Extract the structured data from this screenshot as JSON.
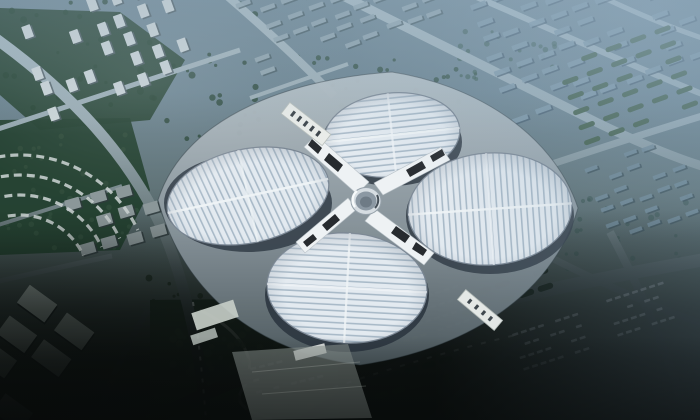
{
  "image": {
    "kind": "architectural-aerial-rendering",
    "subject": "Aerial rendering of a four-petal clover-shaped exhibition center with striped white roofs, central circular hub and X-shaped elevated walkways, surrounded by hazy blue city blocks, tree-lined roads and dark parking lots",
    "visible_text": []
  },
  "palette": {
    "sky_top": "#6f8795",
    "city_top": "#64808f",
    "city_mid": "#55676b",
    "ground_dark": "#0b100f",
    "haze_blue": "#97b0c1",
    "road_light": "#a8bac3",
    "road_dark": "#101515",
    "tree_dark": "#23402f",
    "tree_mid": "#35523f",
    "tree_blue": "#3e5a55",
    "block_white": "#ccd5d8",
    "block_blue": "#7e98a8",
    "roof_base": "#e3eaf0",
    "roof_stripe": "#a9bac8",
    "petal_rim": "#7b8794",
    "petal_under": "#343f49",
    "cross_white": "#eef2f4",
    "cross_black": "#171b1f",
    "hub_gray": "#8b98a3",
    "plaza_light": "#b6c1c7",
    "plaza_dark": "#4f5b60",
    "warehouse": "#9aa7a2",
    "entrance_white": "#e9ece9"
  },
  "scene": {
    "building": {
      "petals": [
        "north",
        "east",
        "south",
        "west"
      ],
      "roof_pattern": "parallel ridges perpendicular to each petal axis with pale spine cross",
      "center": "circular hub with X walkways and black glass wedges"
    },
    "environment": {
      "top": "hazy blue-grey city grid with diagonal streets",
      "top_left": "white tower blocks and dark green park, arc-shaped building rows",
      "top_right": "tree-row parking lot beside east petal",
      "bottom": "dark roads, warehouses and car-filled parking lots fading to black"
    }
  }
}
